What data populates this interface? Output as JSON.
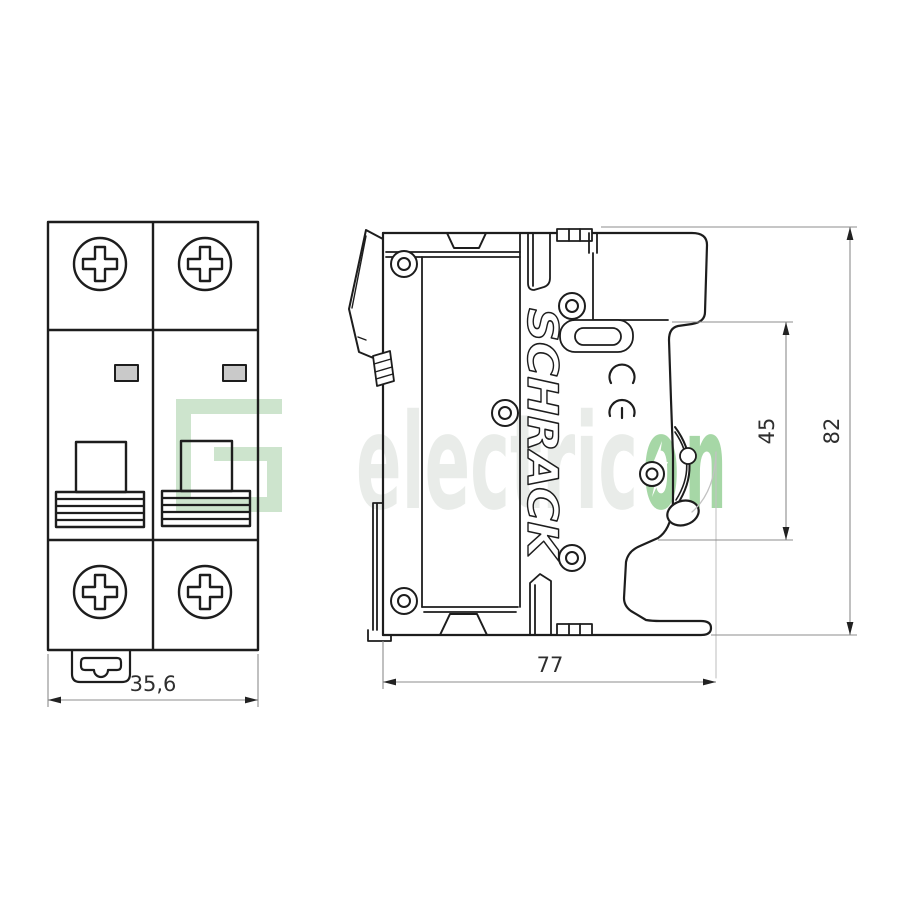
{
  "drawing": {
    "brand_text": "SCHRACK",
    "ce_mark_label": "CE",
    "dimensions": {
      "front_width": "35,6",
      "side_depth": "77",
      "front_height": "45",
      "total_height": "82"
    },
    "watermark": {
      "gray_text": "electric",
      "green_o": "o",
      "green_n": "n"
    },
    "colors": {
      "line": "#1d1d1d",
      "dimension_line": "#8c8c8c",
      "dimension_text": "#2f2f2f",
      "indicator_window_fill": "#c9c9c9",
      "travel_arc": "#c2c2c2",
      "watermark_gray": "#e9ece9",
      "watermark_green": "#a6d7a6",
      "watermark_logo_green": "#cde4cd"
    }
  }
}
